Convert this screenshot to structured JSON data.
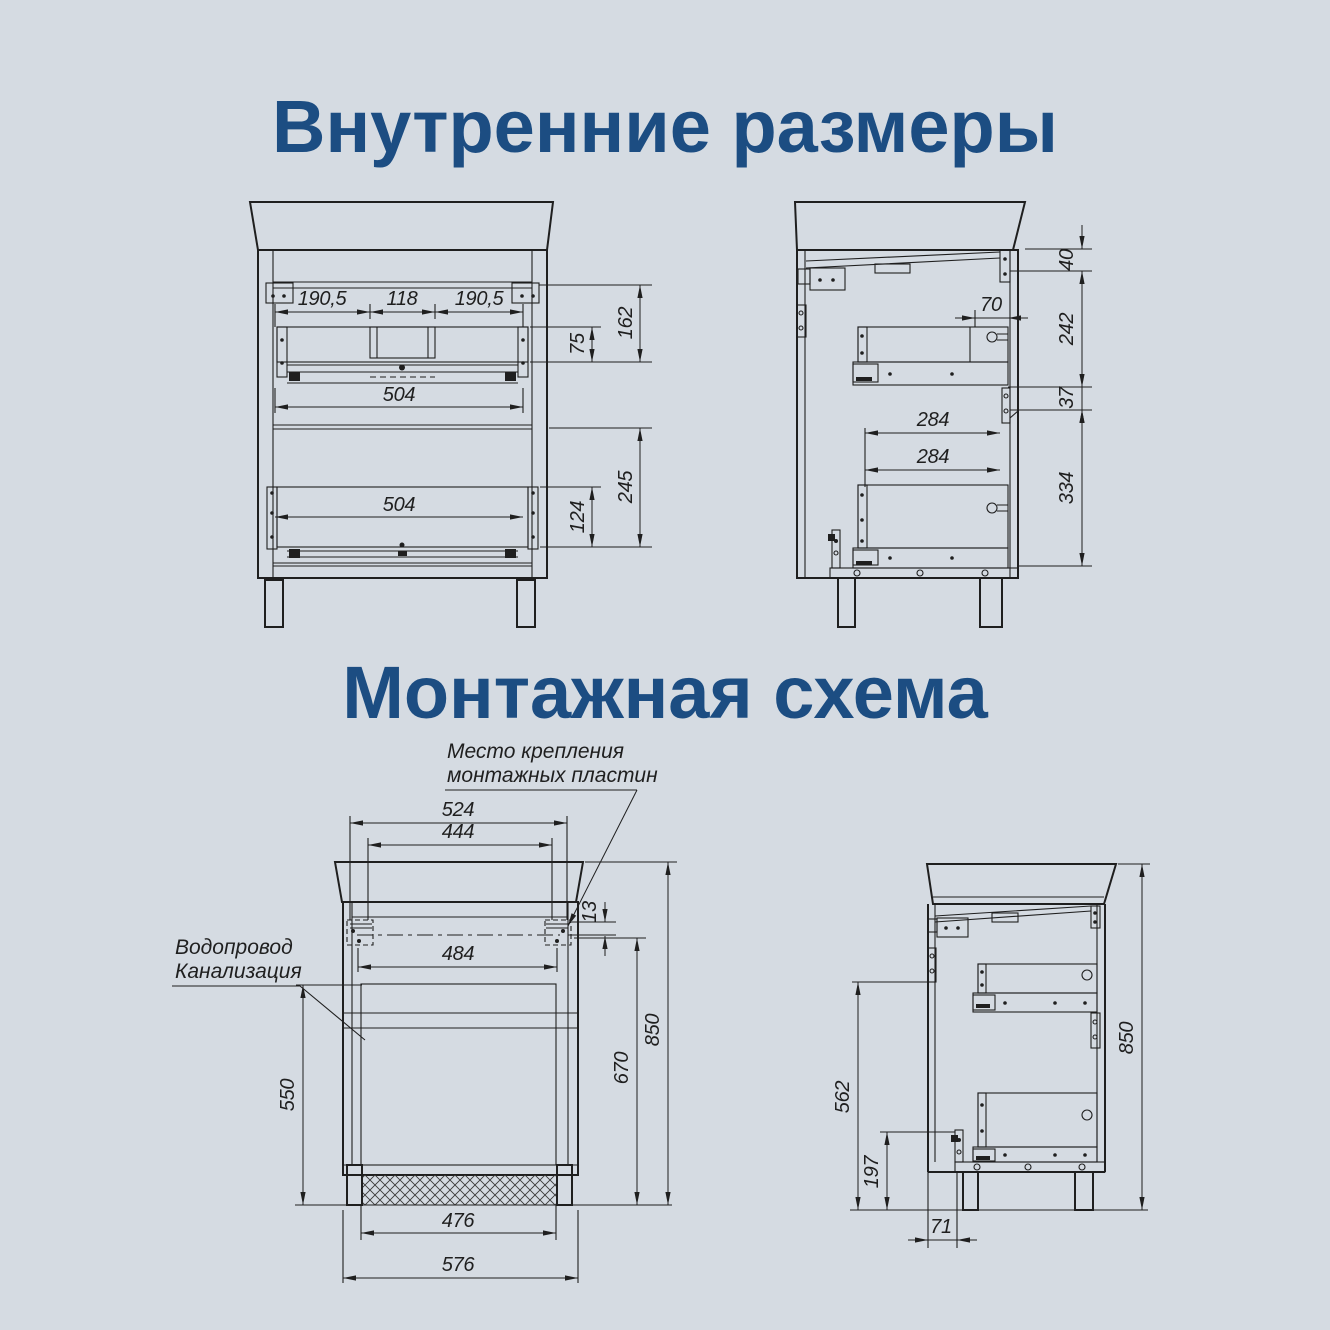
{
  "page": {
    "background": "#d5dbe2",
    "line_color": "#1f1f1f",
    "accent": "#1c4d82"
  },
  "sections": {
    "internal": {
      "title": "Внутренние размеры"
    },
    "mounting": {
      "title": "Монтажная схема"
    }
  },
  "internal_front": {
    "dims": {
      "shelf_left": "190,5",
      "shelf_center": "118",
      "shelf_right": "190,5",
      "drawer1_front_height": "75",
      "section1_height": "162",
      "drawer1_width": "504",
      "drawer2_width": "504",
      "drawer2_front_height": "124",
      "section2_height": "245"
    }
  },
  "internal_side": {
    "dims": {
      "top_gap": "40",
      "rail_inset": "70",
      "section1_height": "242",
      "bracket_gap": "37",
      "drawer1_depth": "284",
      "drawer2_depth": "284",
      "section2_height": "334"
    }
  },
  "mounting_front": {
    "callout_plates": {
      "line1": "Место крепления",
      "line2": "монтажных пластин"
    },
    "callout_plumbing": {
      "line1": "Водопровод",
      "line2": "Канализация"
    },
    "dims": {
      "plates_outer": "524",
      "plates_inner": "444",
      "plate_drop": "13",
      "holes_span": "484",
      "plumbing_height": "550",
      "plates_height": "670",
      "total_height": "850",
      "plumbing_width": "476",
      "total_width": "576"
    }
  },
  "mounting_side": {
    "dims": {
      "bracket_top_height": "562",
      "bracket_bottom_height": "197",
      "total_height": "850",
      "front_offset": "71"
    }
  }
}
